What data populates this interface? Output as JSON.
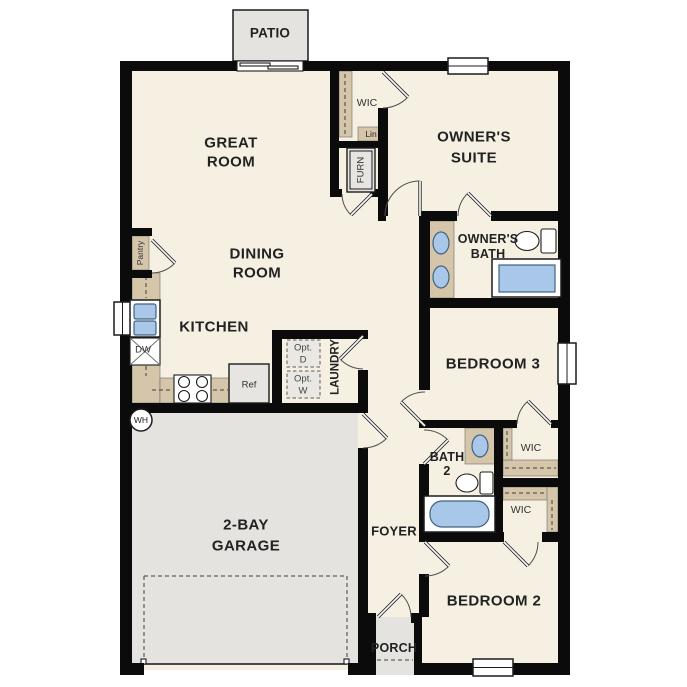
{
  "colors": {
    "floor": "#f6f0e3",
    "wall": "#0b0b0b",
    "counter": "#d5c6aa",
    "garage_floor": "#e4e3e0",
    "fixture_blue": "#a9c8e9",
    "label": "#222222"
  },
  "labels": {
    "patio": "PATIO",
    "great_room": [
      "GREAT",
      "ROOM"
    ],
    "owners_suite": [
      "OWNER'S",
      "SUITE"
    ],
    "dining_room": [
      "DINING",
      "ROOM"
    ],
    "kitchen": "KITCHEN",
    "owners_bath": [
      "OWNER'S",
      "BATH"
    ],
    "bedroom3": "BEDROOM 3",
    "bath2": [
      "BATH",
      "2"
    ],
    "bedroom2": "BEDROOM 2",
    "garage": [
      "2-BAY",
      "GARAGE"
    ],
    "foyer": "FOYER",
    "porch": "PORCH",
    "laundry": "LAUNDRY",
    "wic_owner": "WIC",
    "wic_bed3": "WIC",
    "wic_bed2": "WIC",
    "lin": "Lin",
    "furn": "FURN",
    "pantry": "Pantry",
    "dw": "DW",
    "ref": "Ref",
    "wh": "WH",
    "opt_dryer": [
      "Opt.",
      "D"
    ],
    "opt_washer": [
      "Opt.",
      "W"
    ]
  }
}
